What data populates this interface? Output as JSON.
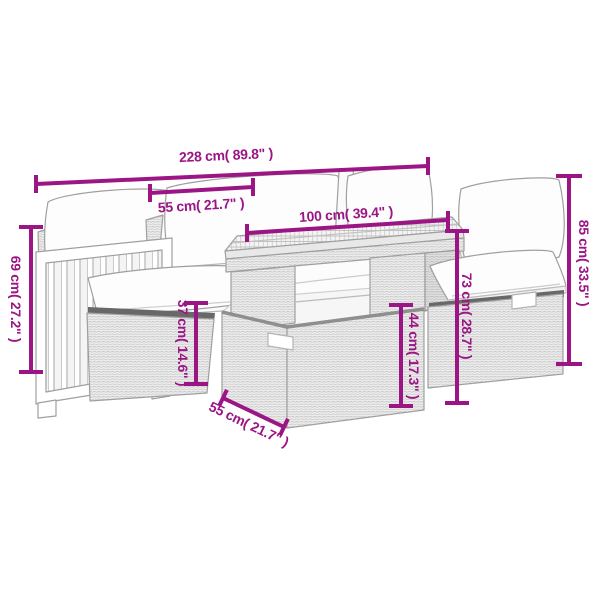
{
  "colors": {
    "accent": "#9C1585",
    "line_art": "#9e9e9e",
    "background": "#ffffff"
  },
  "dimensions": {
    "overall_width": "228 cm( 89.8\" )",
    "seat_width": "55 cm( 21.7\" )",
    "tabletop_length": "100 cm( 39.4\" )",
    "backrest_height": "85 cm( 33.5\" )",
    "table_height": "73 cm( 28.7\" )",
    "table_base_height": "44 cm( 17.3\" )",
    "armrest_height": "69 cm( 27.2\" )",
    "seat_height": "37 cm( 14.6\" )",
    "table_depth": "55 cm( 21.7\" )"
  }
}
